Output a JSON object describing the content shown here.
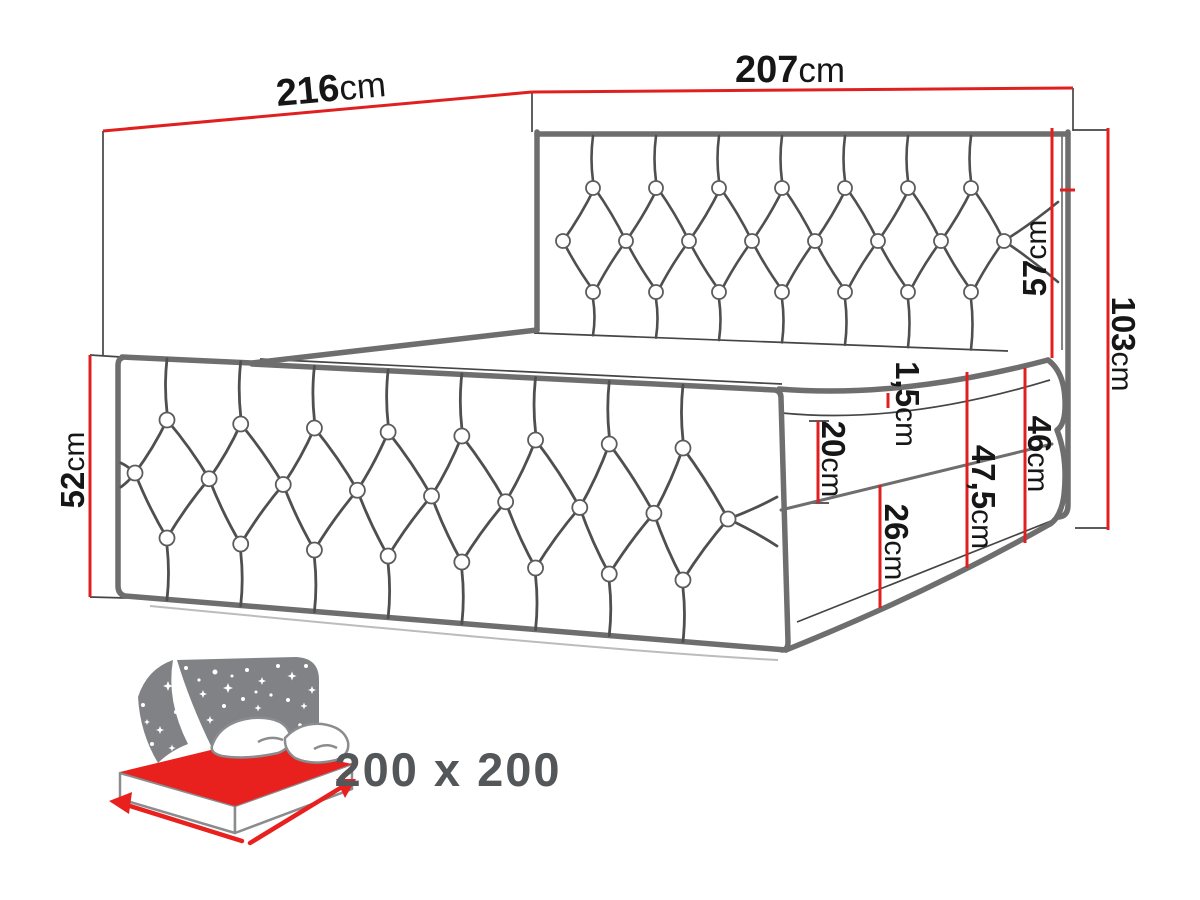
{
  "diagram_name": "bed-dimensions-diagram",
  "dimensions": {
    "back_width": {
      "value": "216",
      "unit": "cm"
    },
    "front_width": {
      "value": "207",
      "unit": "cm"
    },
    "side_panel_height": {
      "value": "52",
      "unit": "cm"
    },
    "headboard_above_mattress": {
      "value": "57",
      "unit": "cm"
    },
    "total_height": {
      "value": "103",
      "unit": "cm"
    },
    "topper_seam": {
      "value": "1,5",
      "unit": "cm"
    },
    "mattress_height": {
      "value": "20",
      "unit": "cm"
    },
    "mattress_plus_base": {
      "value": "47,5",
      "unit": "cm"
    },
    "box_height": {
      "value": "46",
      "unit": "cm"
    },
    "lower_base_height": {
      "value": "26",
      "unit": "cm"
    }
  },
  "size_badge": "200 x 200",
  "colors": {
    "dimension_red": "#e02020",
    "outline_gray": "#6e6e6e",
    "line_dark": "#454545",
    "tuft_gray": "#4f4f4f",
    "icon_gray": "#808285",
    "icon_red": "#e8201e",
    "badge_text": "#54575a"
  }
}
